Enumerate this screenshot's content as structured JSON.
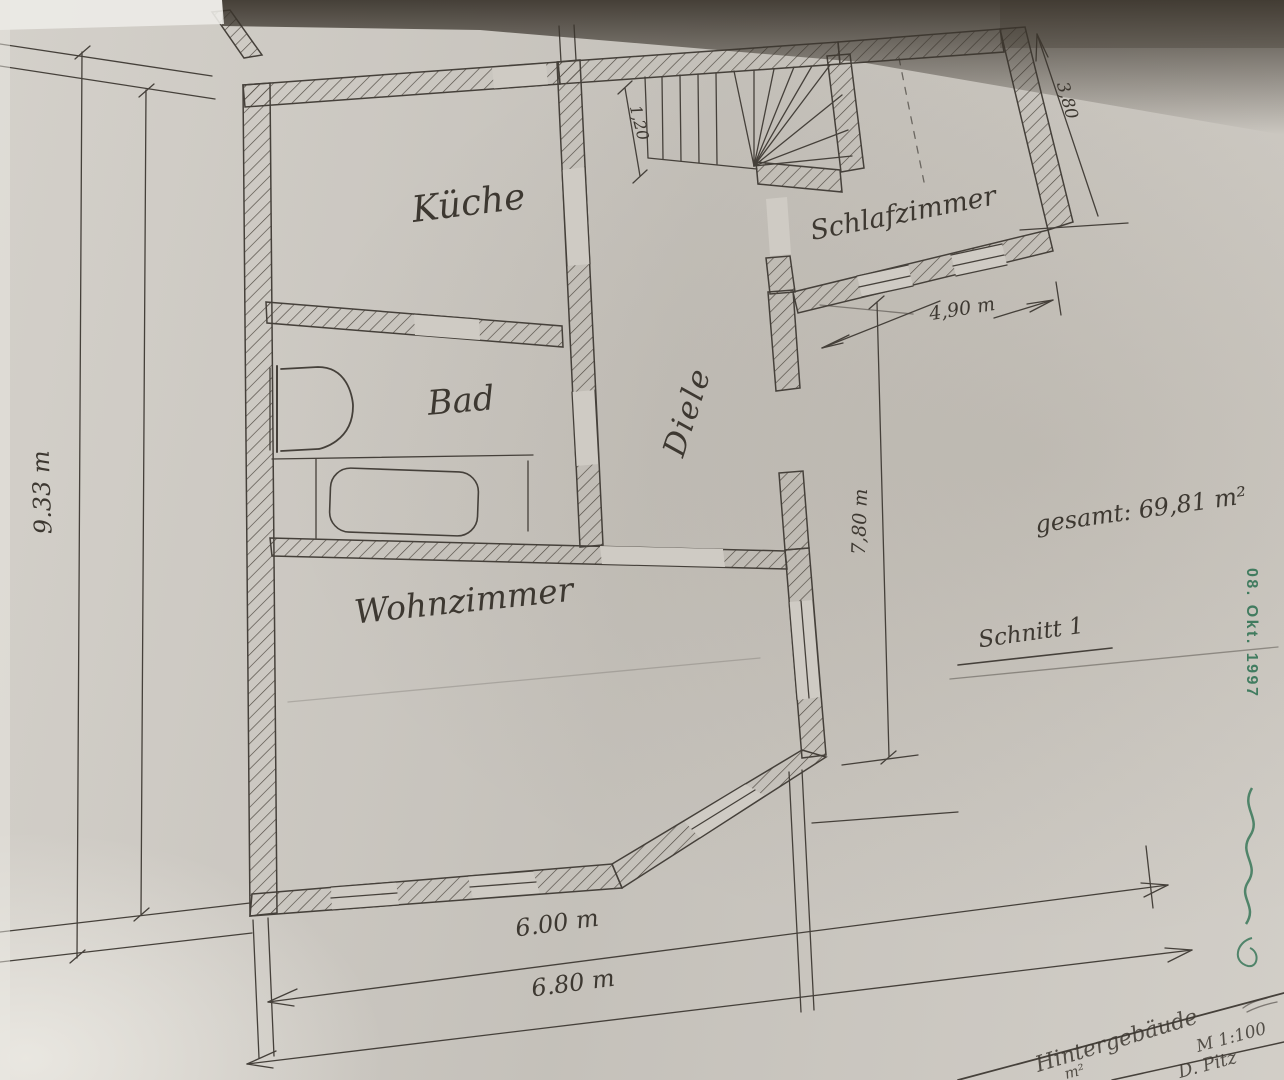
{
  "rooms": {
    "kueche": "Küche",
    "bad": "Bad",
    "diele": "Diele",
    "schlafzimmer": "Schlafzimmer",
    "wohnzimmer": "Wohnzimmer"
  },
  "dimensions": {
    "left_height": "9.33 m",
    "bottom_inner_width": "6.00 m",
    "bottom_outer_width": "6.80 m",
    "schlafzimmer_width": "4,90 m",
    "right_height": "7,80 m",
    "schlafzimmer_depth": "3,80",
    "stair_width": "1,20"
  },
  "annotations": {
    "total_area": "gesamt: 69,81 m²",
    "section_label": "Schnitt 1"
  },
  "stamp": {
    "date_text": "08. Okt. 1997",
    "color": "#2f7253"
  },
  "title_block": {
    "building_text": "Hintergebäude",
    "scale_text": "M 1:100",
    "name_text": "D. Pitz",
    "fragment": "m²"
  },
  "colors": {
    "paper": "#cfcbc4",
    "ink": "#45403a",
    "stamp_green": "#2f7253"
  }
}
